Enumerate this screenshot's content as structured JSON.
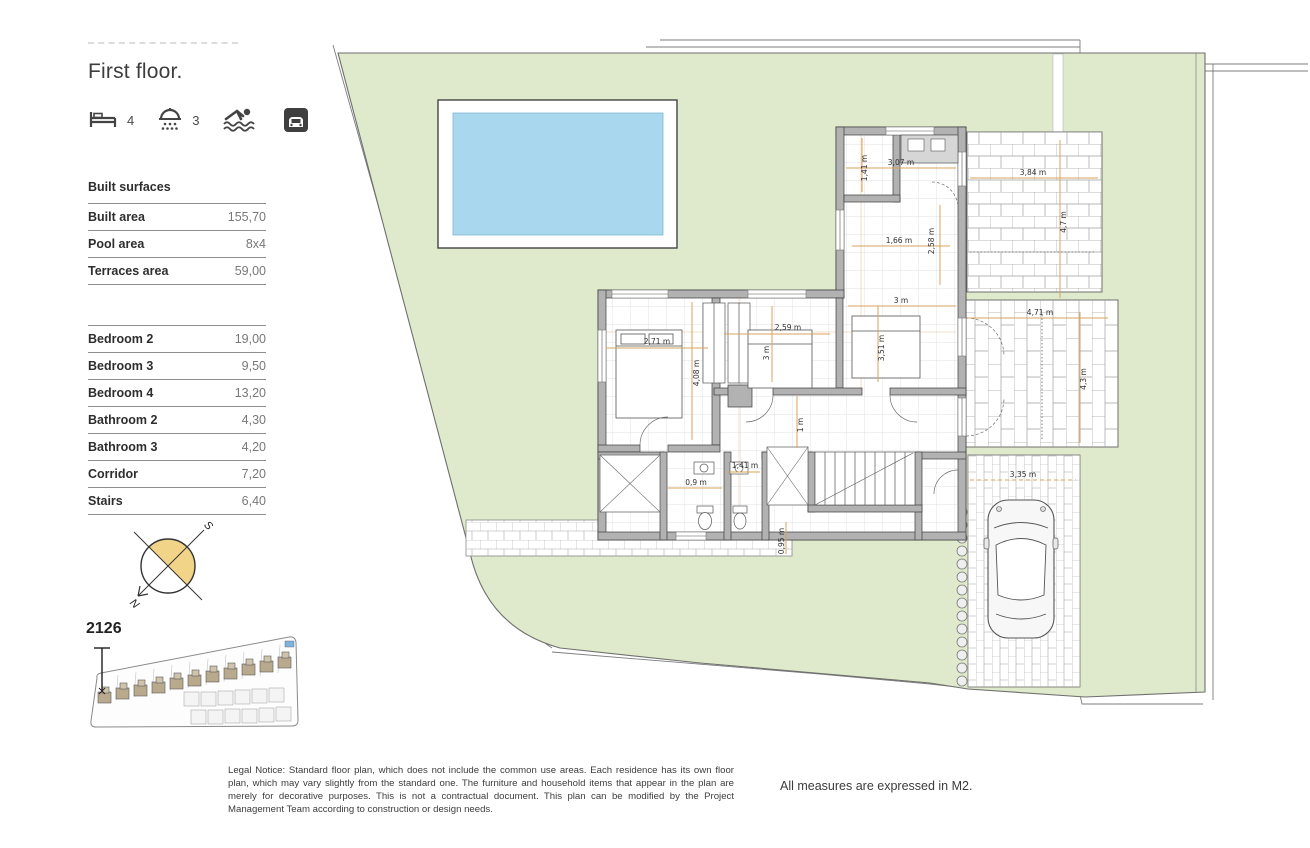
{
  "header": {
    "title": "First floor.",
    "features": {
      "bedrooms_count": "4",
      "bathrooms_count": "3"
    }
  },
  "surfaces": {
    "heading": "Built surfaces",
    "rows": [
      {
        "label": "Built area",
        "value": "155,70"
      },
      {
        "label": "Pool area",
        "value": "8x4"
      },
      {
        "label": "Terraces area",
        "value": "59,00"
      }
    ]
  },
  "rooms": {
    "rows": [
      {
        "label": "Bedroom 2",
        "value": "19,00"
      },
      {
        "label": "Bedroom 3",
        "value": "9,50"
      },
      {
        "label": "Bedroom 4",
        "value": "13,20"
      },
      {
        "label": "Bathroom 2",
        "value": "4,30"
      },
      {
        "label": "Bathroom 3",
        "value": "4,20"
      },
      {
        "label": "Corridor",
        "value": "7,20"
      },
      {
        "label": "Stairs",
        "value": "6,40"
      }
    ]
  },
  "compass": {
    "south": "S",
    "north": "N"
  },
  "site": {
    "unit_number": "2126"
  },
  "plan": {
    "dims": {
      "laundry_h": "1,41 m",
      "kitchen_top_w": "3,07 m",
      "terrace_top_w": "3,84 m",
      "terrace_top_h": "4,7 m",
      "kitchen_w": "1,66 m",
      "kitchen_h": "2,58 m",
      "hall_top_w": "3 m",
      "bedroom2_w": "2,71 m",
      "bedroom2_h": "4,08 m",
      "bedroom3_w": "2,59 m",
      "bedroom3_h": "3 m",
      "bedroom4_h": "3,51 m",
      "terrace_right_w": "4,71 m",
      "terrace_right_h": "4,3 m",
      "corridor_h": "1 m",
      "bathroom2_w": "0,9 m",
      "bathroom3_w": "1,41 m",
      "driveway_w": "3,35 m",
      "path_h": "0,95 m"
    }
  },
  "footer": {
    "legal_notice": "Legal Notice: Standard floor plan, which does not include the common use areas. Each residence has its own floor plan, which may vary slightly from the standard one. The furniture and household items that appear in the plan are merely for decorative purposes. This is not a contractual document. This plan can be modified by the Project Management Team according to construction or design needs.",
    "measures_note": "All measures are expressed in M2."
  },
  "colors": {
    "garden": "#dfe9cb",
    "pool_water": "#a9d8ee",
    "wall": "#b2b2b2",
    "dimension_line": "#d8a35c",
    "compass_fill": "#f1d488"
  }
}
